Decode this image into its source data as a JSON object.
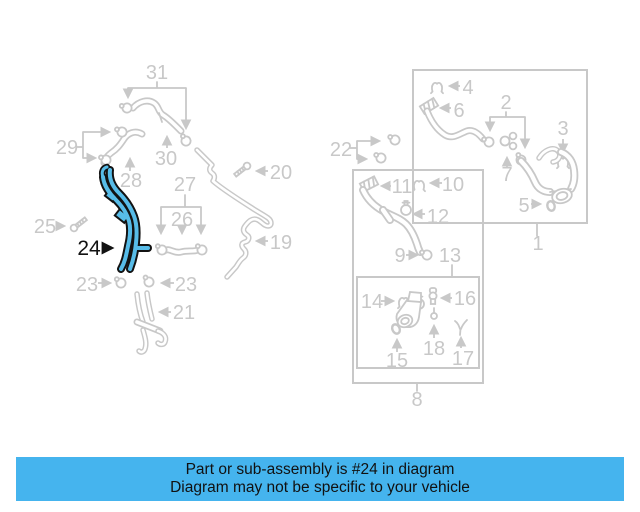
{
  "page": {
    "type": "auto-parts-diagram",
    "highlighted_part": "24"
  },
  "colors": {
    "background": "#ffffff",
    "diagram_lines": "#c8c8c8",
    "highlight_outline": "#121212",
    "highlight_fill": "#57bce8",
    "banner_bg": "#45b4ee",
    "banner_text": "#111111"
  },
  "banner": {
    "line1": "Part or sub-assembly is #24 in diagram",
    "line2": "Diagram may not be specific to your vehicle"
  },
  "part_labels": [
    {
      "text": "31",
      "x": 157,
      "y": 79
    },
    {
      "text": "30",
      "x": 166,
      "y": 165
    },
    {
      "text": "29",
      "x": 67,
      "y": 154
    },
    {
      "text": "28",
      "x": 131,
      "y": 187
    },
    {
      "text": "27",
      "x": 185,
      "y": 191
    },
    {
      "text": "26",
      "x": 182,
      "y": 226
    },
    {
      "text": "25",
      "x": 45,
      "y": 233
    },
    {
      "text": "24",
      "x": 89,
      "y": 255,
      "highlight": true
    },
    {
      "text": "23",
      "x": 87,
      "y": 291
    },
    {
      "text": "23",
      "x": 186,
      "y": 291
    },
    {
      "text": "21",
      "x": 184,
      "y": 319
    },
    {
      "text": "20",
      "x": 281,
      "y": 179
    },
    {
      "text": "19",
      "x": 281,
      "y": 249
    },
    {
      "text": "22",
      "x": 341,
      "y": 156
    },
    {
      "text": "11",
      "x": 402,
      "y": 193
    },
    {
      "text": "10",
      "x": 453,
      "y": 191
    },
    {
      "text": "12",
      "x": 438,
      "y": 223
    },
    {
      "text": "9",
      "x": 400,
      "y": 262
    },
    {
      "text": "13",
      "x": 450,
      "y": 262
    },
    {
      "text": "14",
      "x": 372,
      "y": 308
    },
    {
      "text": "16",
      "x": 465,
      "y": 305
    },
    {
      "text": "15",
      "x": 397,
      "y": 367
    },
    {
      "text": "18",
      "x": 434,
      "y": 355
    },
    {
      "text": "17",
      "x": 463,
      "y": 365
    },
    {
      "text": "8",
      "x": 417,
      "y": 406
    },
    {
      "text": "4",
      "x": 468,
      "y": 94
    },
    {
      "text": "6",
      "x": 459,
      "y": 117
    },
    {
      "text": "2",
      "x": 506,
      "y": 109
    },
    {
      "text": "3",
      "x": 563,
      "y": 135
    },
    {
      "text": "7",
      "x": 507,
      "y": 181
    },
    {
      "text": "5",
      "x": 524,
      "y": 212
    },
    {
      "text": "1",
      "x": 538,
      "y": 250
    }
  ]
}
